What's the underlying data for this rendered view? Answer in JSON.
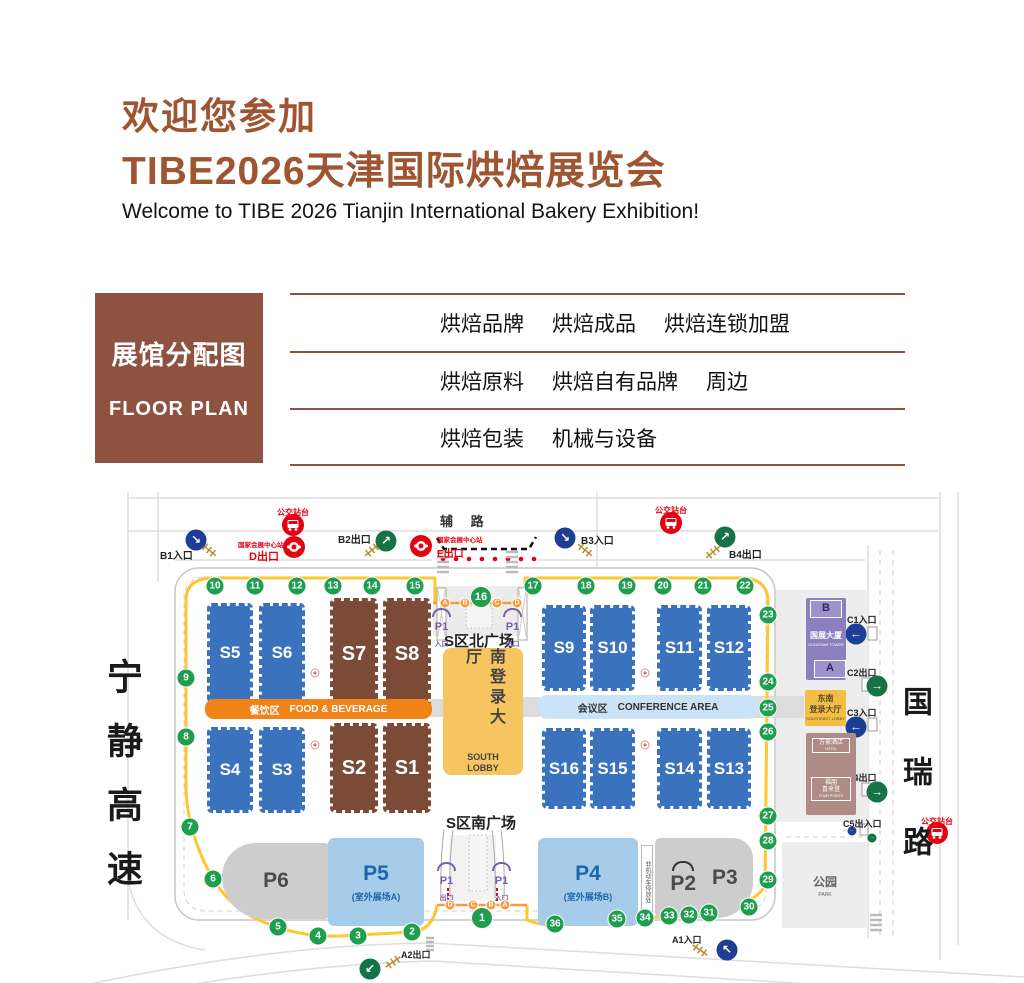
{
  "header": {
    "title_line1": "欢迎您参加",
    "title_line2": "TIBE2026天津国际烘焙展览会",
    "subtitle": "Welcome to TIBE 2026 Tianjin International Bakery Exhibition!"
  },
  "legend": {
    "title_zh": "展馆分配图",
    "title_en": "FLOOR PLAN",
    "rows": [
      {
        "hall": "S1馆",
        "items": [
          "烘焙品牌",
          "烘焙成品",
          "烘焙连锁加盟"
        ]
      },
      {
        "hall": "S2馆",
        "items": [
          "烘焙原料",
          "烘焙自有品牌",
          "周边"
        ]
      },
      {
        "hall": "S7-S8馆",
        "items": [
          "烘焙包装",
          "机械与设备"
        ]
      }
    ]
  },
  "map": {
    "roads": {
      "west": "宁静高速",
      "east": "国瑞路",
      "north": "辅 路"
    },
    "transit": {
      "bus_stop": "公交站台",
      "station": "国家会展中心站",
      "exit_d": "D出口",
      "exit_e": "E出口"
    },
    "gates": {
      "b1": "B1入口",
      "b2": "B2出口",
      "b3": "B3入口",
      "b4": "B4出口",
      "a1": "A1入口",
      "a2": "A2出口",
      "c1": "C1入口",
      "c2": "C2出口",
      "c3": "C3入口",
      "c4": "C4出口",
      "c5": "C5出入口"
    },
    "halls": {
      "s1": "S1",
      "s2": "S2",
      "s3": "S3",
      "s4": "S4",
      "s5": "S5",
      "s6": "S6",
      "s7": "S7",
      "s8": "S8",
      "s9": "S9",
      "s10": "S10",
      "s11": "S11",
      "s12": "S12",
      "s13": "S13",
      "s14": "S14",
      "s15": "S15",
      "s16": "S16"
    },
    "zones": {
      "fb_zh": "餐饮区",
      "fb_en": "FOOD & BEVERAGE",
      "conf_zh": "会议区",
      "conf_en": "CONFERENCE AREA",
      "north_plaza": "S区北广场",
      "south_plaza": "S区南广场",
      "lobby_zh": "南登录大厅",
      "lobby_en1": "SOUTH",
      "lobby_en2": "LOBBY"
    },
    "p1": {
      "label": "P1",
      "in": "入口",
      "out": "出口"
    },
    "parking": {
      "p2": "P2",
      "p3": "P3",
      "p4": "P4",
      "p4_sub": "(室外展场B)",
      "p5": "P5",
      "p5_sub": "(室外展场A)",
      "p6": "P6",
      "bike": "非机动车停放处"
    },
    "annex": {
      "tower_b": "B",
      "tower_a": "A",
      "tower_zh": "国展大厦",
      "tower_en": "GUOZHAN TOWER",
      "se_lobby_zh1": "东南",
      "se_lobby_zh2": "登录大厅",
      "se_lobby_en": "SOUTHEAST LOBBY",
      "hotel1_zh": "万豪酒店",
      "hotel1_en": "HOTEL",
      "hotel2_zh1": "福朋",
      "hotel2_zh2": "喜来登",
      "hotel2_en": "FOUR POINTS",
      "park_zh": "公园",
      "park_en": "PARK"
    },
    "stops": [
      "1",
      "2",
      "3",
      "4",
      "5",
      "6",
      "7",
      "8",
      "9",
      "10",
      "11",
      "12",
      "13",
      "14",
      "15",
      "16",
      "17",
      "18",
      "19",
      "20",
      "21",
      "22",
      "23",
      "24",
      "25",
      "26",
      "27",
      "28",
      "29",
      "30",
      "31",
      "32",
      "33",
      "34",
      "35",
      "36"
    ],
    "letters_north": [
      "A",
      "B",
      "C",
      "D"
    ],
    "letters_south": [
      "D",
      "C",
      "B",
      "A"
    ],
    "colors": {
      "brand_brown": "#9E5531",
      "legend_brown": "#8D5340",
      "hall_blue": "#3B72BD",
      "hall_brown": "#7C4B37",
      "route_green": "#1E9E4E",
      "path_yellow": "#FFC62E",
      "letter_orange": "#F49B3F",
      "accent_red": "#E60012",
      "fb_orange": "#F08418",
      "conf_blue": "#CBE3F6",
      "lobby_yellow": "#F6C55F",
      "tower_purple": "#8C7FC0",
      "hotel_mauve": "#AF8B85",
      "parking_blue": "#A7CCEA",
      "entry_blue": "#1D3E94",
      "exit_green": "#157347",
      "p1_purple": "#7B5EA7"
    }
  }
}
